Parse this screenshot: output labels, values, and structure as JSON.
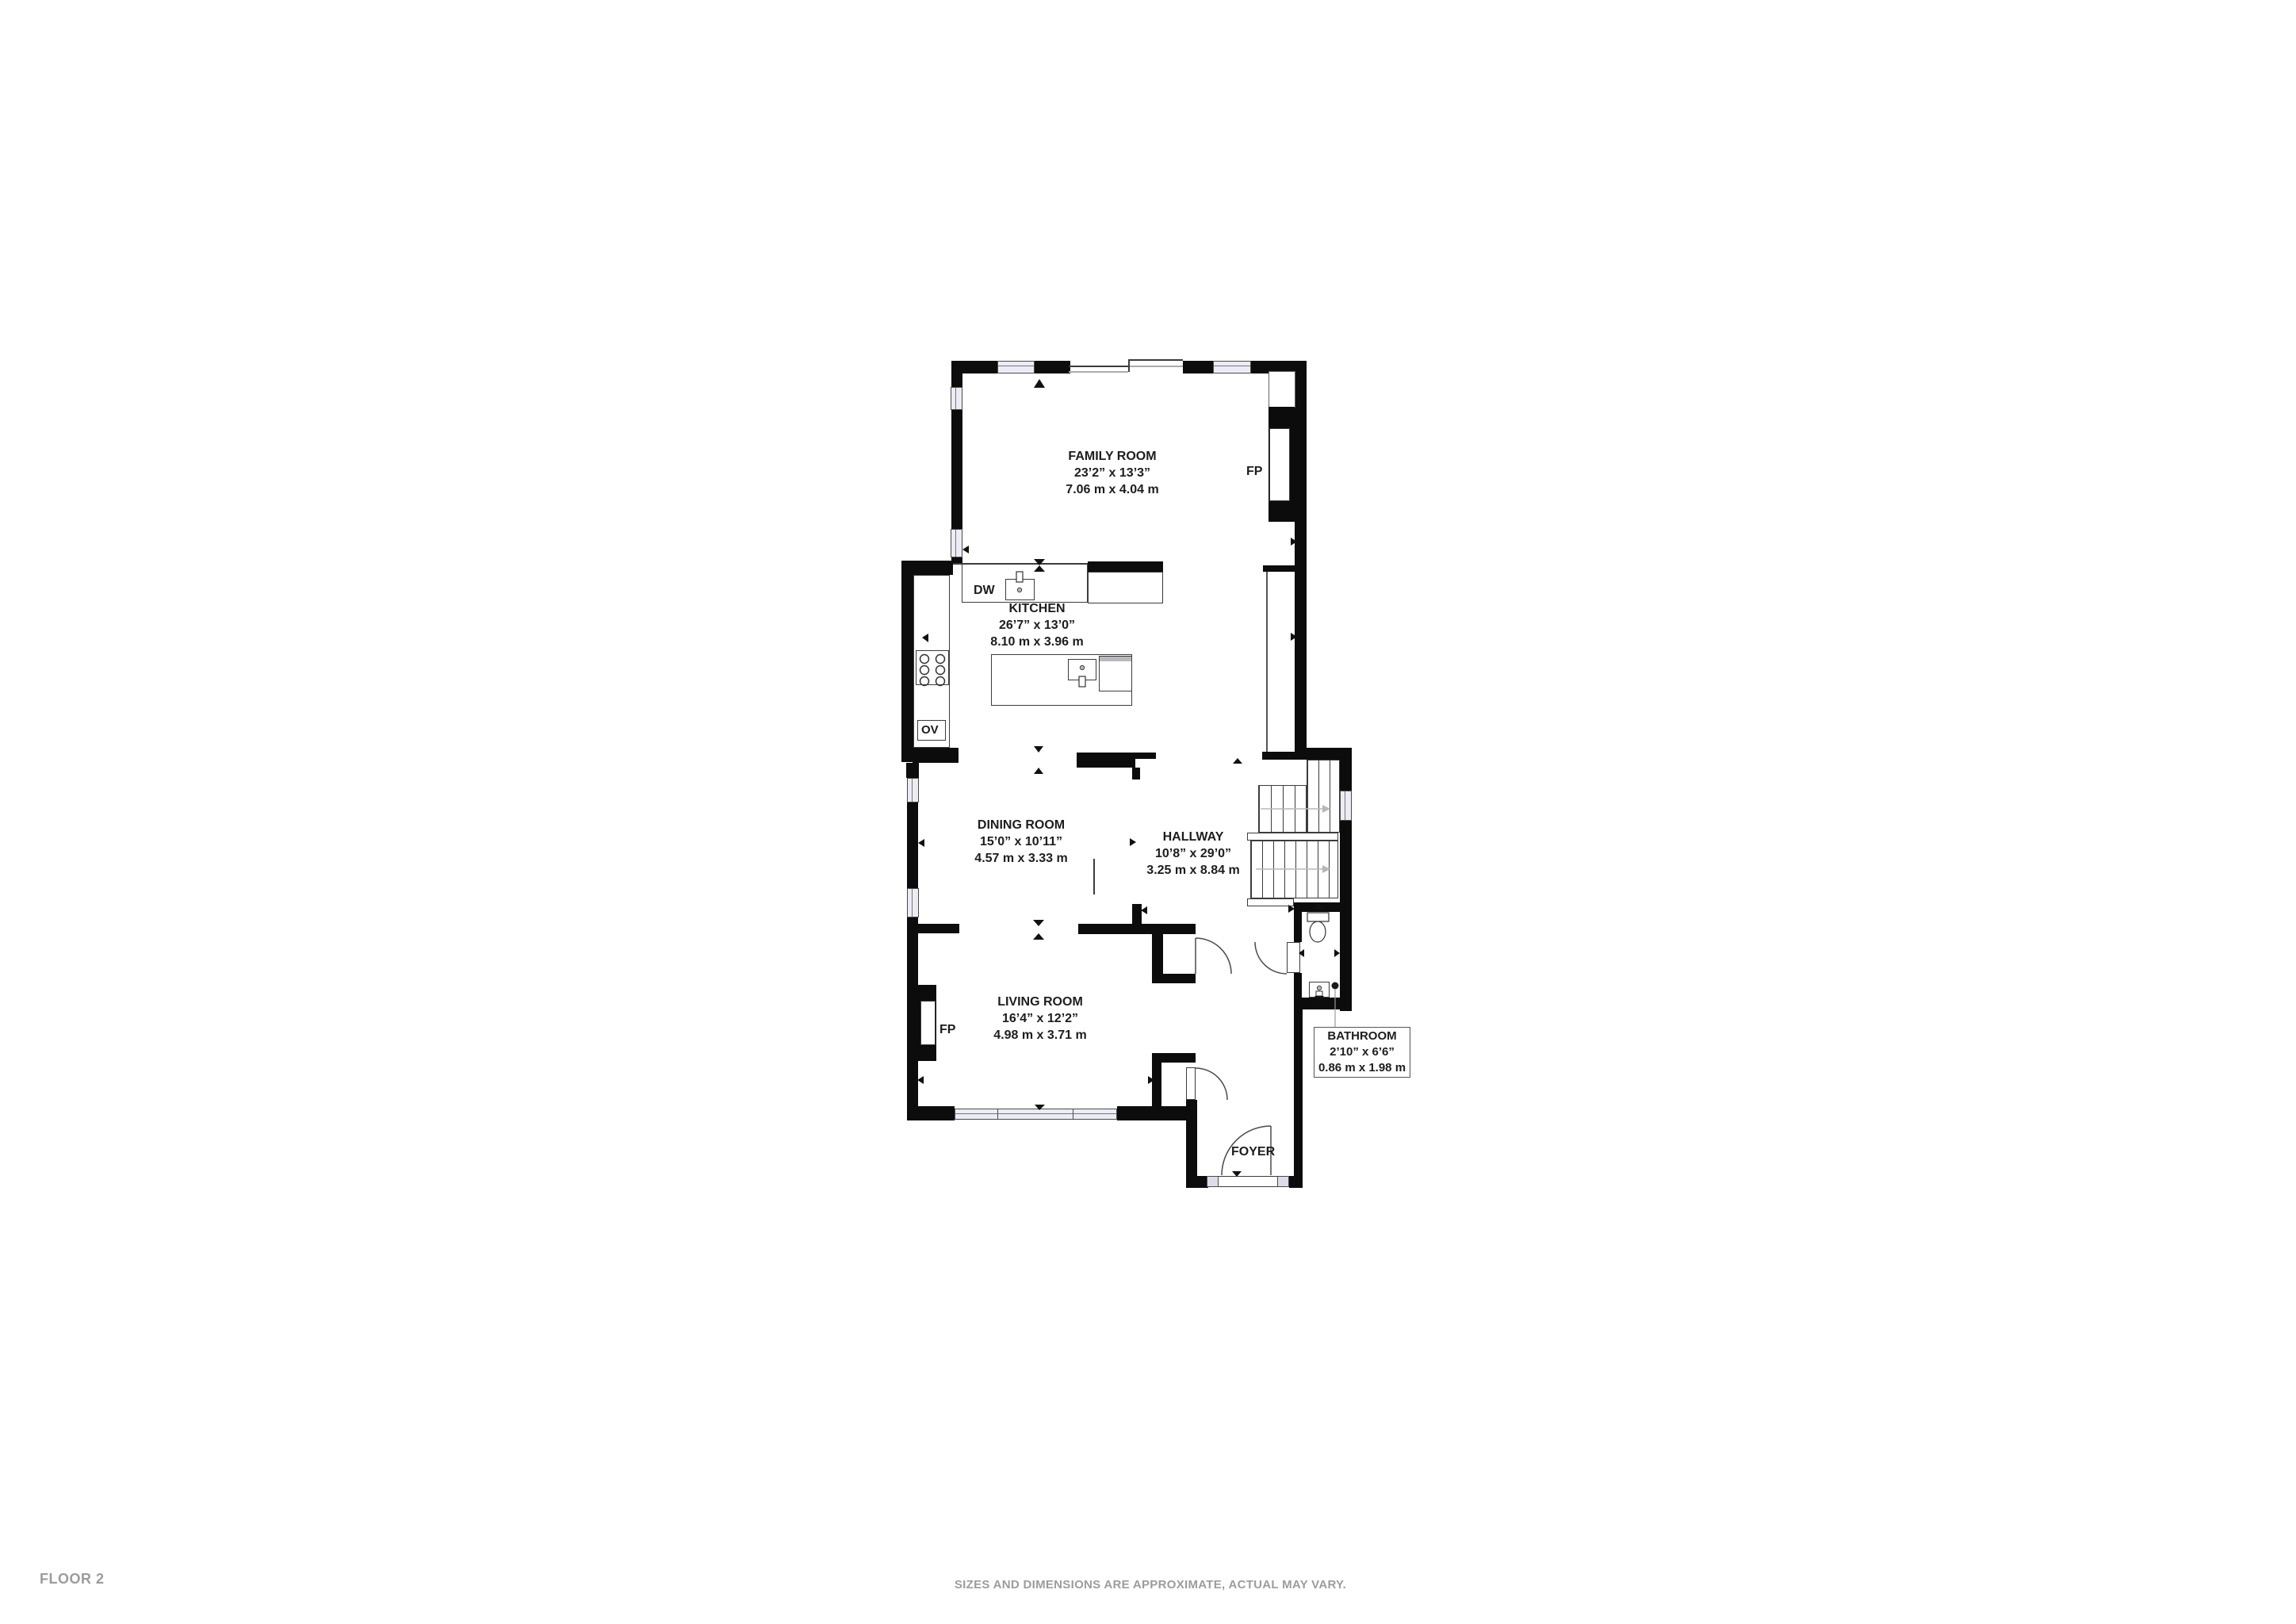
{
  "rooms": {
    "family_room": {
      "name": "FAMILY ROOM",
      "imperial": "23’2” x 13’3”",
      "metric": "7.06 m x 4.04 m"
    },
    "kitchen": {
      "name": "KITCHEN",
      "imperial": "26’7” x 13’0”",
      "metric": "8.10 m x 3.96 m"
    },
    "dining_room": {
      "name": "DINING ROOM",
      "imperial": "15’0” x 10’11”",
      "metric": "4.57 m x 3.33 m"
    },
    "hallway": {
      "name": "HALLWAY",
      "imperial": "10’8” x 29’0”",
      "metric": "3.25 m x 8.84 m"
    },
    "living_room": {
      "name": "LIVING ROOM",
      "imperial": "16’4” x 12’2”",
      "metric": "4.98 m x 3.71 m"
    },
    "bathroom": {
      "name": "BATHROOM",
      "imperial": "2’10” x 6’6”",
      "metric": "0.86 m x 1.98 m"
    },
    "foyer": {
      "name": "FOYER"
    }
  },
  "labels": {
    "fireplace": "FP",
    "dishwasher": "DW",
    "oven": "OV"
  },
  "footer": {
    "floor_label": "FLOOR 2",
    "disclaimer": "SIZES AND DIMENSIONS ARE APPROXIMATE, ACTUAL MAY VARY."
  },
  "colors": {
    "wall": "#0c0c0c",
    "window_fill": "#ececf5",
    "text": "#1d1d1d",
    "footer_text": "#9c9c9c",
    "stair_arrow": "#b8b8b8"
  }
}
